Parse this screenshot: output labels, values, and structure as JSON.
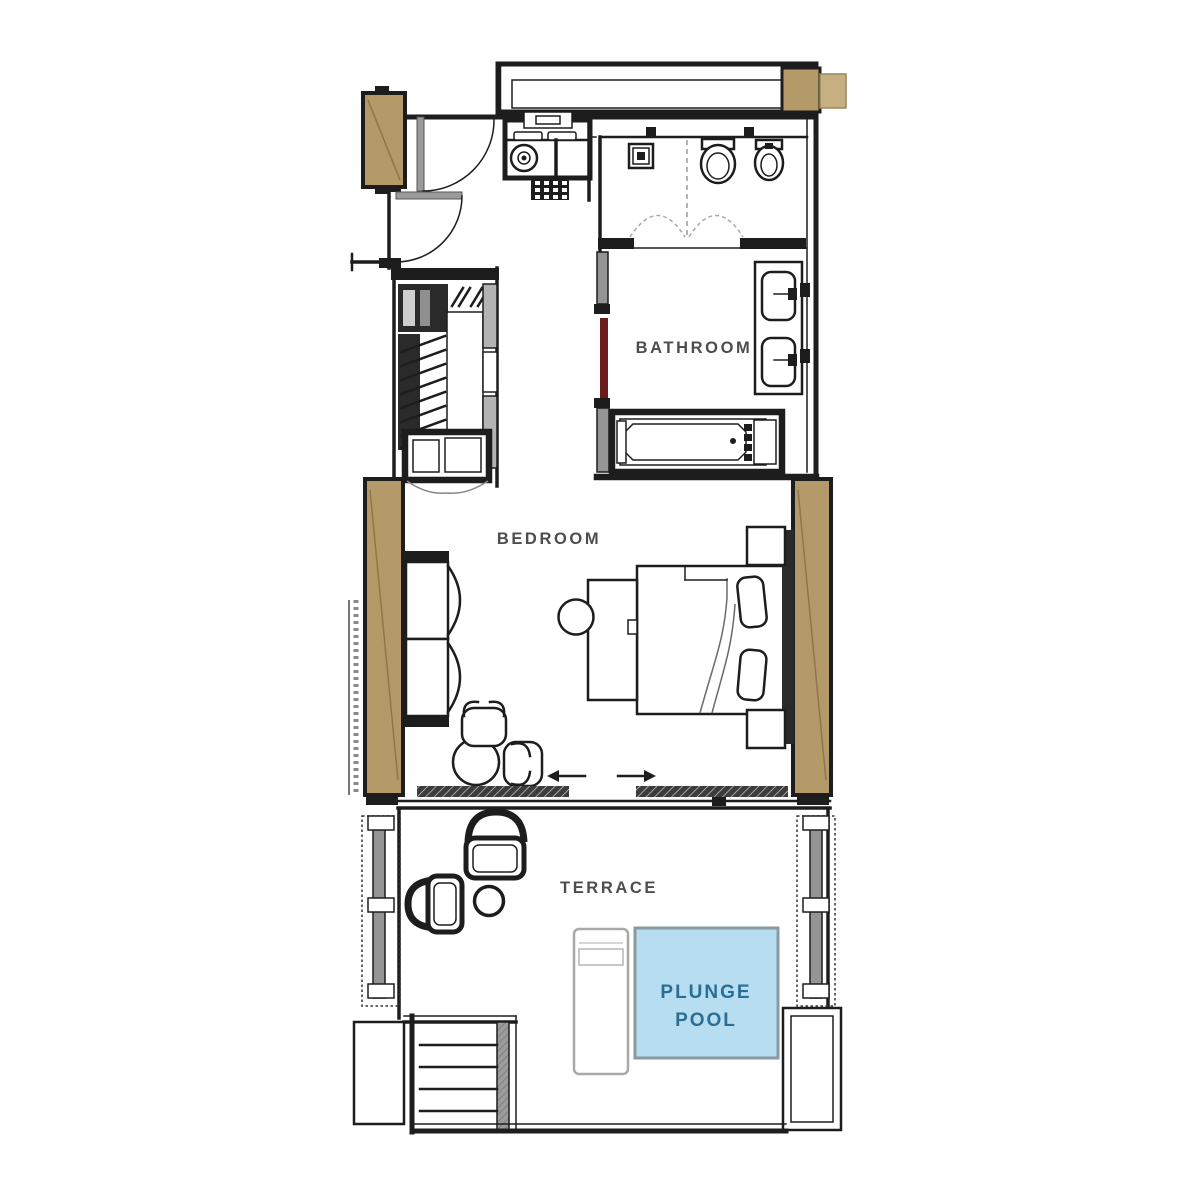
{
  "document": {
    "type": "floor-plan",
    "view": "top-down suite plan"
  },
  "labels": {
    "bathroom": "BATHROOM",
    "bedroom": "BEDROOM",
    "terrace": "TERRACE",
    "plunge_pool": [
      "PLUNGE",
      "POOL"
    ]
  },
  "rooms": [
    {
      "label": "BATHROOM"
    },
    {
      "label": "BEDROOM"
    },
    {
      "label": "TERRACE"
    },
    {
      "label": "PLUNGE POOL"
    }
  ],
  "colors": {
    "wood": "#b49a69",
    "wood_light": "#c5af83",
    "wood_grain": "#8f774a",
    "pool_fill": "#b7ddf0",
    "pool_border": "#8b99a2",
    "pool_text": "#2b6e95",
    "door_red": "#6b1d1d",
    "label_text": "#4d4d4d",
    "line": "#1d1d1d"
  }
}
